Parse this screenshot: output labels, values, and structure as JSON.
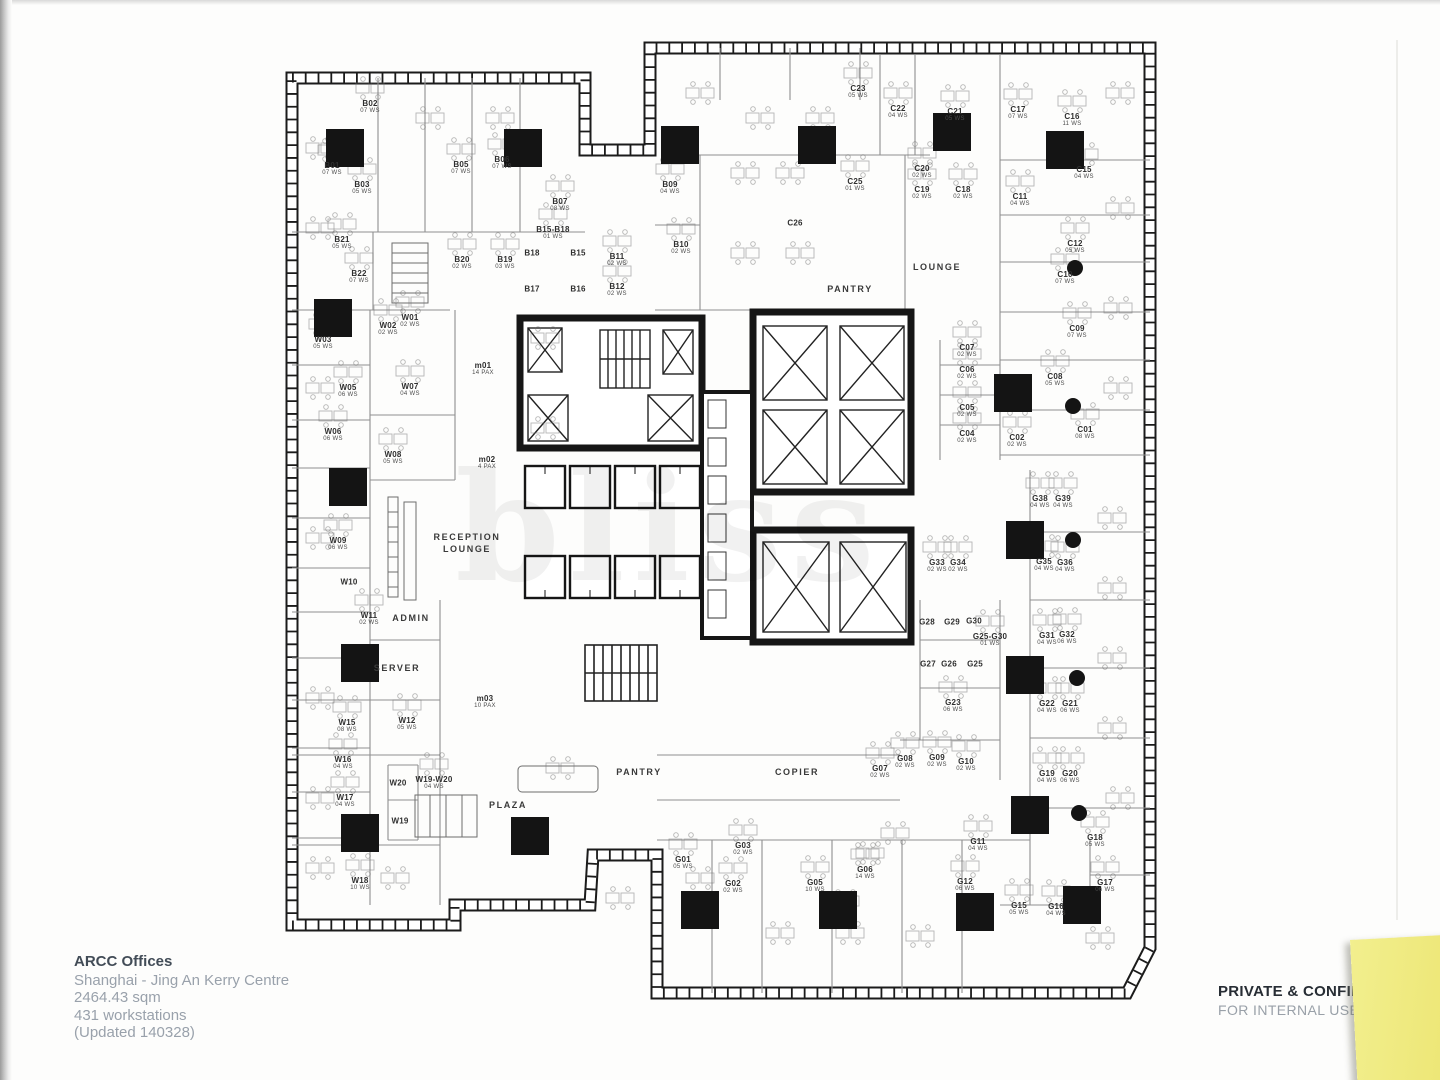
{
  "footer": {
    "title": "ARCC Offices",
    "lines": [
      "Shanghai - Jing An Kerry Centre",
      "2464.43 sqm",
      "431 workstations",
      "(Updated 140328)"
    ]
  },
  "stamp": {
    "line1": "PRIVATE & CONFIDE",
    "line2": "FOR INTERNAL USE O"
  },
  "watermark": {
    "text": "bliss"
  },
  "colors": {
    "ink": "#1b1b1b",
    "wall_gray": "#9a9a9a",
    "label": "#2e2e2e",
    "note_yellow": "#f0ec85"
  },
  "areas": [
    {
      "label": "PANTRY",
      "x": 850,
      "y": 289
    },
    {
      "label": "LOUNGE",
      "x": 937,
      "y": 267
    },
    {
      "label": "RECEPTION\nLOUNGE",
      "x": 467,
      "y": 543
    },
    {
      "label": "ADMIN",
      "x": 411,
      "y": 618
    },
    {
      "label": "SERVER",
      "x": 397,
      "y": 668
    },
    {
      "label": "PLAZA",
      "x": 508,
      "y": 805
    },
    {
      "label": "PANTRY",
      "x": 639,
      "y": 772
    },
    {
      "label": "COPIER",
      "x": 797,
      "y": 772
    }
  ],
  "rooms": [
    {
      "id": "B02",
      "ws": "07 WS",
      "x": 370,
      "y": 107
    },
    {
      "id": "B01",
      "ws": "07 WS",
      "x": 332,
      "y": 169
    },
    {
      "id": "B03",
      "ws": "05 WS",
      "x": 362,
      "y": 188
    },
    {
      "id": "B05",
      "ws": "07 WS",
      "x": 461,
      "y": 168
    },
    {
      "id": "B06",
      "ws": "07 WS",
      "x": 502,
      "y": 163
    },
    {
      "id": "B07",
      "ws": "08 WS",
      "x": 560,
      "y": 205
    },
    {
      "id": "B15-B18",
      "ws": "01 WS",
      "x": 553,
      "y": 233
    },
    {
      "id": "B20",
      "ws": "02 WS",
      "x": 462,
      "y": 263
    },
    {
      "id": "B19",
      "ws": "03 WS",
      "x": 505,
      "y": 263
    },
    {
      "id": "B18",
      "ws": "",
      "x": 532,
      "y": 253
    },
    {
      "id": "B17",
      "ws": "",
      "x": 532,
      "y": 289
    },
    {
      "id": "B15",
      "ws": "",
      "x": 578,
      "y": 253
    },
    {
      "id": "B16",
      "ws": "",
      "x": 578,
      "y": 289
    },
    {
      "id": "B11",
      "ws": "02 WS",
      "x": 617,
      "y": 260
    },
    {
      "id": "B12",
      "ws": "02 WS",
      "x": 617,
      "y": 290
    },
    {
      "id": "B21",
      "ws": "05 WS",
      "x": 342,
      "y": 243
    },
    {
      "id": "B22",
      "ws": "07 WS",
      "x": 359,
      "y": 277
    },
    {
      "id": "B09",
      "ws": "04 WS",
      "x": 670,
      "y": 188
    },
    {
      "id": "B10",
      "ws": "02 WS",
      "x": 681,
      "y": 248
    },
    {
      "id": "C23",
      "ws": "05 WS",
      "x": 858,
      "y": 92
    },
    {
      "id": "C22",
      "ws": "04 WS",
      "x": 898,
      "y": 112
    },
    {
      "id": "C21",
      "ws": "05 WS",
      "x": 955,
      "y": 115
    },
    {
      "id": "C20",
      "ws": "02 WS",
      "x": 922,
      "y": 172
    },
    {
      "id": "C19",
      "ws": "02 WS",
      "x": 922,
      "y": 193
    },
    {
      "id": "C18",
      "ws": "02 WS",
      "x": 963,
      "y": 193
    },
    {
      "id": "C25",
      "ws": "01 WS",
      "x": 855,
      "y": 185
    },
    {
      "id": "C26",
      "ws": "",
      "x": 795,
      "y": 223
    },
    {
      "id": "C17",
      "ws": "07 WS",
      "x": 1018,
      "y": 113
    },
    {
      "id": "C16",
      "ws": "11 WS",
      "x": 1072,
      "y": 120
    },
    {
      "id": "C15",
      "ws": "04 WS",
      "x": 1084,
      "y": 173
    },
    {
      "id": "C11",
      "ws": "04 WS",
      "x": 1020,
      "y": 200
    },
    {
      "id": "C12",
      "ws": "05 WS",
      "x": 1075,
      "y": 247
    },
    {
      "id": "C10",
      "ws": "07 WS",
      "x": 1065,
      "y": 278
    },
    {
      "id": "C09",
      "ws": "07 WS",
      "x": 1077,
      "y": 332
    },
    {
      "id": "C08",
      "ws": "05 WS",
      "x": 1055,
      "y": 380
    },
    {
      "id": "C07",
      "ws": "02 WS",
      "x": 967,
      "y": 351
    },
    {
      "id": "C06",
      "ws": "02 WS",
      "x": 967,
      "y": 373
    },
    {
      "id": "C05",
      "ws": "02 WS",
      "x": 967,
      "y": 411
    },
    {
      "id": "C04",
      "ws": "02 WS",
      "x": 967,
      "y": 437
    },
    {
      "id": "C02",
      "ws": "02 WS",
      "x": 1017,
      "y": 441
    },
    {
      "id": "C01",
      "ws": "08 WS",
      "x": 1085,
      "y": 433
    },
    {
      "id": "W01",
      "ws": "02 WS",
      "x": 410,
      "y": 321
    },
    {
      "id": "W02",
      "ws": "02 WS",
      "x": 388,
      "y": 329
    },
    {
      "id": "W03",
      "ws": "05 WS",
      "x": 323,
      "y": 343
    },
    {
      "id": "W05",
      "ws": "06 WS",
      "x": 348,
      "y": 391
    },
    {
      "id": "W07",
      "ws": "04 WS",
      "x": 410,
      "y": 390
    },
    {
      "id": "W06",
      "ws": "06 WS",
      "x": 333,
      "y": 435
    },
    {
      "id": "W08",
      "ws": "05 WS",
      "x": 393,
      "y": 458
    },
    {
      "id": "W09",
      "ws": "06 WS",
      "x": 338,
      "y": 544
    },
    {
      "id": "W10",
      "ws": "",
      "x": 349,
      "y": 582
    },
    {
      "id": "m01",
      "ws": "14 PAX",
      "x": 483,
      "y": 369
    },
    {
      "id": "m02",
      "ws": "4 PAX",
      "x": 487,
      "y": 463
    },
    {
      "id": "m03",
      "ws": "10 PAX",
      "x": 485,
      "y": 702
    },
    {
      "id": "W11",
      "ws": "02 WS",
      "x": 369,
      "y": 619
    },
    {
      "id": "W15",
      "ws": "08 WS",
      "x": 347,
      "y": 726
    },
    {
      "id": "W12",
      "ws": "05 WS",
      "x": 407,
      "y": 724
    },
    {
      "id": "W16",
      "ws": "04 WS",
      "x": 343,
      "y": 763
    },
    {
      "id": "W17",
      "ws": "04 WS",
      "x": 345,
      "y": 801
    },
    {
      "id": "W20",
      "ws": "",
      "x": 398,
      "y": 783
    },
    {
      "id": "W19",
      "ws": "",
      "x": 400,
      "y": 821
    },
    {
      "id": "W19-W20",
      "ws": "04 WS",
      "x": 434,
      "y": 783
    },
    {
      "id": "W18",
      "ws": "10 WS",
      "x": 360,
      "y": 884
    },
    {
      "id": "G01",
      "ws": "05 WS",
      "x": 683,
      "y": 863
    },
    {
      "id": "G02",
      "ws": "02 WS",
      "x": 733,
      "y": 887
    },
    {
      "id": "G03",
      "ws": "02 WS",
      "x": 743,
      "y": 849
    },
    {
      "id": "G05",
      "ws": "10 WS",
      "x": 815,
      "y": 886
    },
    {
      "id": "G06",
      "ws": "14 WS",
      "x": 865,
      "y": 873
    },
    {
      "id": "G07",
      "ws": "02 WS",
      "x": 880,
      "y": 772
    },
    {
      "id": "G08",
      "ws": "02 WS",
      "x": 905,
      "y": 762
    },
    {
      "id": "G09",
      "ws": "02 WS",
      "x": 937,
      "y": 761
    },
    {
      "id": "G10",
      "ws": "02 WS",
      "x": 966,
      "y": 765
    },
    {
      "id": "G28",
      "ws": "",
      "x": 927,
      "y": 622
    },
    {
      "id": "G29",
      "ws": "",
      "x": 952,
      "y": 622
    },
    {
      "id": "G30",
      "ws": "",
      "x": 974,
      "y": 621
    },
    {
      "id": "G25-G30",
      "ws": "01 WS",
      "x": 990,
      "y": 640
    },
    {
      "id": "G27",
      "ws": "",
      "x": 928,
      "y": 664
    },
    {
      "id": "G26",
      "ws": "",
      "x": 949,
      "y": 664
    },
    {
      "id": "G25",
      "ws": "",
      "x": 975,
      "y": 664
    },
    {
      "id": "G23",
      "ws": "06 WS",
      "x": 953,
      "y": 706
    },
    {
      "id": "G33",
      "ws": "02 WS",
      "x": 937,
      "y": 566
    },
    {
      "id": "G34",
      "ws": "02 WS",
      "x": 958,
      "y": 566
    },
    {
      "id": "G38",
      "ws": "04 WS",
      "x": 1040,
      "y": 502
    },
    {
      "id": "G39",
      "ws": "04 WS",
      "x": 1063,
      "y": 502
    },
    {
      "id": "G35",
      "ws": "04 WS",
      "x": 1044,
      "y": 565
    },
    {
      "id": "G36",
      "ws": "04 WS",
      "x": 1065,
      "y": 566
    },
    {
      "id": "G31",
      "ws": "04 WS",
      "x": 1047,
      "y": 639
    },
    {
      "id": "G32",
      "ws": "06 WS",
      "x": 1067,
      "y": 638
    },
    {
      "id": "G22",
      "ws": "04 WS",
      "x": 1047,
      "y": 707
    },
    {
      "id": "G21",
      "ws": "06 WS",
      "x": 1070,
      "y": 707
    },
    {
      "id": "G19",
      "ws": "04 WS",
      "x": 1047,
      "y": 777
    },
    {
      "id": "G20",
      "ws": "06 WS",
      "x": 1070,
      "y": 777
    },
    {
      "id": "G11",
      "ws": "04 WS",
      "x": 978,
      "y": 845
    },
    {
      "id": "G18",
      "ws": "05 WS",
      "x": 1095,
      "y": 841
    },
    {
      "id": "G12",
      "ws": "06 WS",
      "x": 965,
      "y": 885
    },
    {
      "id": "G15",
      "ws": "05 WS",
      "x": 1019,
      "y": 909
    },
    {
      "id": "G16",
      "ws": "04 WS",
      "x": 1056,
      "y": 910
    },
    {
      "id": "G17",
      "ws": "06 WS",
      "x": 1105,
      "y": 886
    }
  ],
  "columns": [
    [
      345,
      148
    ],
    [
      523,
      148
    ],
    [
      680,
      145
    ],
    [
      817,
      145
    ],
    [
      952,
      132
    ],
    [
      1065,
      150
    ],
    [
      333,
      318
    ],
    [
      348,
      487
    ],
    [
      360,
      663
    ],
    [
      360,
      833
    ],
    [
      530,
      836
    ],
    [
      700,
      910
    ],
    [
      838,
      910
    ],
    [
      975,
      912
    ],
    [
      1082,
      905
    ],
    [
      1025,
      540
    ],
    [
      1025,
      675
    ],
    [
      1030,
      815
    ],
    [
      1013,
      393
    ]
  ],
  "dots": [
    [
      1075,
      268
    ],
    [
      1073,
      406
    ],
    [
      1073,
      540
    ],
    [
      1077,
      678
    ],
    [
      1079,
      813
    ]
  ],
  "desk_clusters": [
    [
      760,
      120
    ],
    [
      820,
      120
    ],
    [
      745,
      175
    ],
    [
      790,
      175
    ],
    [
      745,
      255
    ],
    [
      800,
      255
    ],
    [
      700,
      95
    ],
    [
      545,
      340
    ],
    [
      545,
      430
    ],
    [
      870,
      855
    ],
    [
      895,
      835
    ],
    [
      845,
      903
    ],
    [
      320,
      870
    ],
    [
      395,
      880
    ],
    [
      620,
      900
    ],
    [
      700,
      880
    ],
    [
      780,
      935
    ],
    [
      850,
      935
    ],
    [
      920,
      938
    ],
    [
      1100,
      940
    ],
    [
      1120,
      800
    ],
    [
      1112,
      730
    ],
    [
      1112,
      660
    ],
    [
      1112,
      590
    ],
    [
      1112,
      520
    ],
    [
      1120,
      95
    ],
    [
      1120,
      210
    ],
    [
      1118,
      310
    ],
    [
      1118,
      390
    ],
    [
      320,
      150
    ],
    [
      430,
      120
    ],
    [
      500,
      120
    ],
    [
      320,
      230
    ],
    [
      320,
      390
    ],
    [
      320,
      540
    ],
    [
      320,
      700
    ],
    [
      320,
      800
    ],
    [
      560,
      770
    ]
  ]
}
